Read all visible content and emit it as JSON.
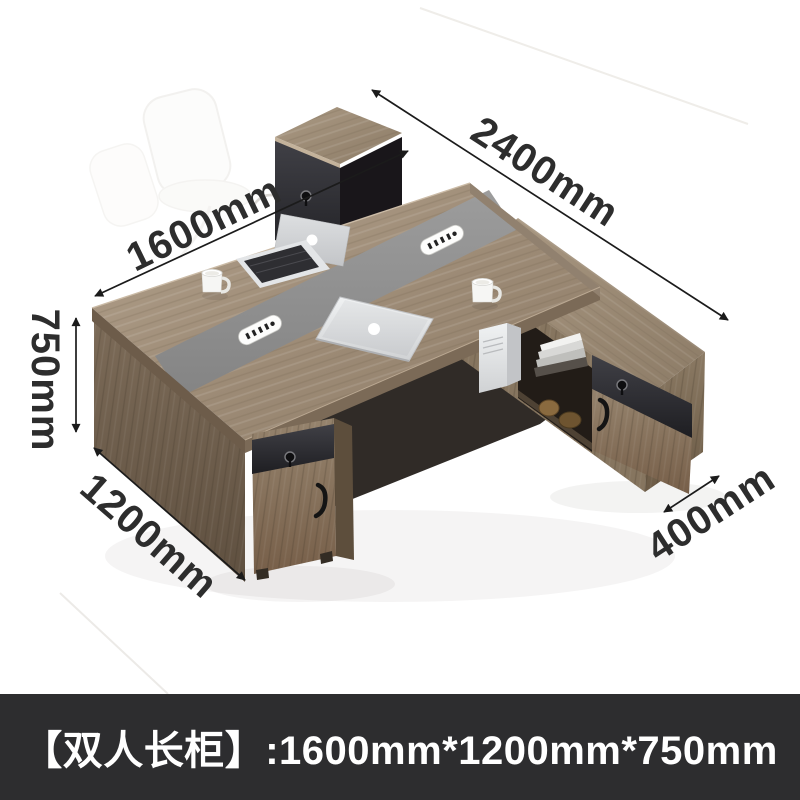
{
  "banner": {
    "text": "【双人长柜】:1600mm*1200mm*750mm",
    "background": "#2d2d2f",
    "text_color": "#ffffff"
  },
  "dimensions": {
    "total_length": "2400mm",
    "desk_length": "1600mm",
    "desk_height": "750mm",
    "desk_depth": "1200mm",
    "side_cabinet_depth": "400mm"
  },
  "scene": {
    "description": "L-shaped double office workstation, gray-walnut wood with dark accent drawer fronts and center cable channel",
    "objects": [
      "open-laptop",
      "closed-laptop",
      "coffee-cup-left",
      "coffee-cup-right",
      "pc-tower",
      "books",
      "decor-items",
      "power-outlet-modules",
      "keyhole-locks",
      "door-handles",
      "ghost-chair-outline"
    ],
    "colors": {
      "wood_top": "#a2917c",
      "wood_side": "#6f5f4c",
      "dark_panel": "#2c2c30",
      "stripe": "#8f8f8f",
      "arrow": "#1b1b1b",
      "dimension_text": "#2d2d2d",
      "background": "#ffffff"
    }
  }
}
